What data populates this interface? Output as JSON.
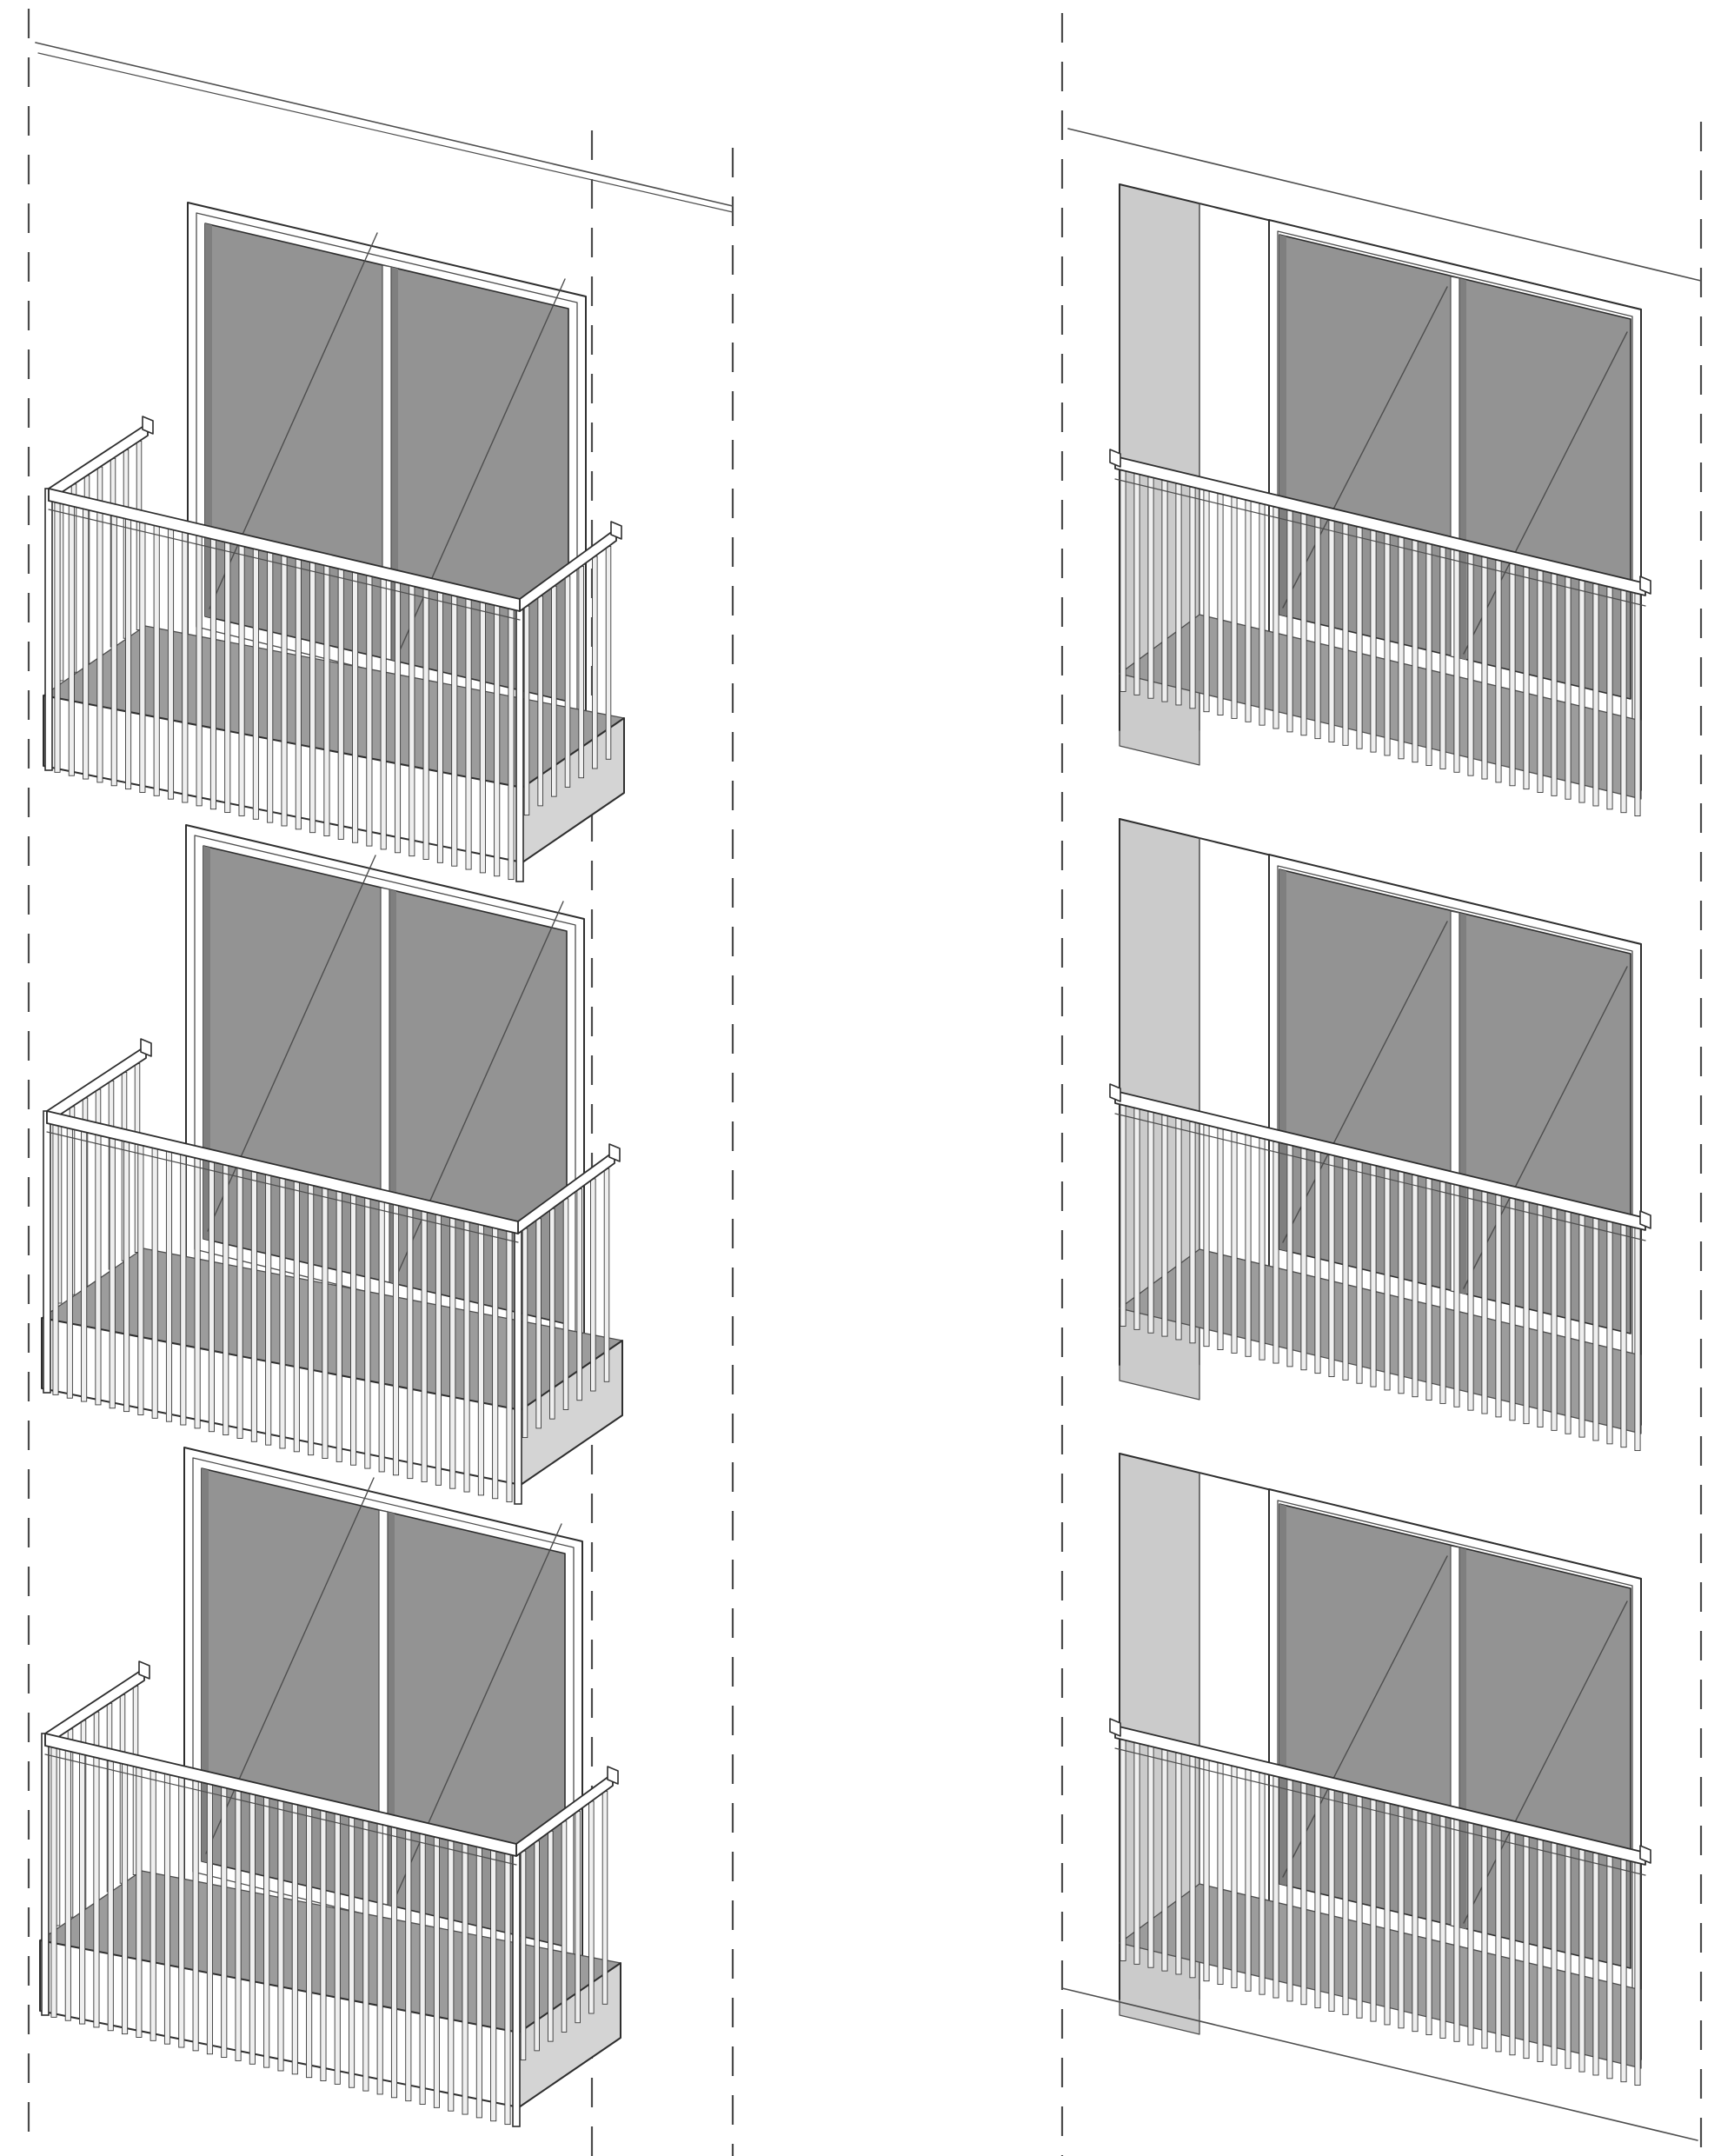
{
  "drawing": {
    "description": "Axonometric architectural detail drawing of two balcony variants over three floors: projecting cantilevered balconies with vertical baluster railings (left column) and recessed loggia balconies with flush baluster railings (right column), each floor with a two-leaf sliding glass door. Dashed vertical guide lines mark the facade bay boundaries. No text or dimensions appear on the sheet.",
    "background": "#ffffff",
    "line_color": "#2e2e2e",
    "thin_line_color": "#4e4e4e",
    "dashed_guide_color": "#4a4a4a",
    "colors": {
      "glass": "#939393",
      "glass_shade": "#7f7f7f",
      "floor": "#9c9c9c",
      "slab_side": "#d4d4d4",
      "side_panel": "#cbcbcb",
      "baluster": "#efefef",
      "baluster_edge": "#3a3a3a",
      "rail": "#ffffff",
      "frame": "#ffffff"
    },
    "floors": 3,
    "guide_lines": 5,
    "columns": [
      {
        "name": "projecting-balcony-column",
        "variant": "cantilevered balcony, vertical baluster railing wrapping three sides, white slab with grey soffit, sliding glass door behind",
        "floors": 3,
        "front_balusters": 33,
        "side_balusters": 7
      },
      {
        "name": "recessed-balcony-column",
        "variant": "recessed loggia balcony, flush vertical baluster railing hanging past the floor slab, grey side reveal panel, sliding glass door at back",
        "floors": 3,
        "front_balusters": 38,
        "side_balusters": 0
      }
    ]
  }
}
